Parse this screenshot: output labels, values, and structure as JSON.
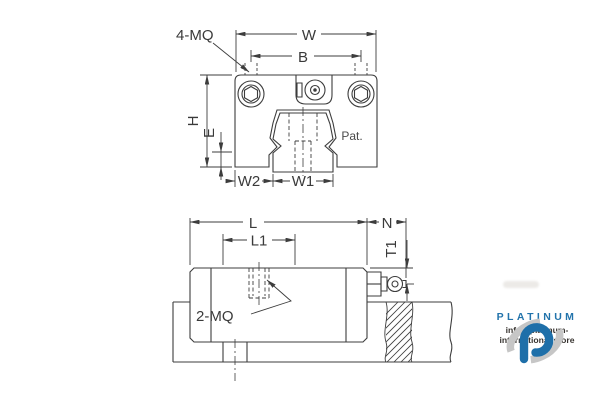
{
  "drawing": {
    "line_color": "#3d3d3d",
    "top_view": {
      "description": "front cross-section view of linear guide carriage on rail",
      "labels": {
        "mq4": "4-MQ",
        "w": "W",
        "b": "B",
        "h": "H",
        "e": "E",
        "w2": "W2",
        "w1": "W1",
        "pat": "Pat."
      }
    },
    "side_view": {
      "description": "side view of carriage on rail with broken-out hatched section",
      "labels": {
        "l": "L",
        "l1": "L1",
        "n": "N",
        "t1": "T1",
        "mq2": "2-MQ"
      }
    }
  },
  "branding": {
    "wordmark": "PLATINUM",
    "email": "info@platinum-international.store",
    "brand_blue": "#1e6fa9",
    "wordmark_blue": "#2273ab",
    "swirl_gray": "#c6c6c6"
  }
}
